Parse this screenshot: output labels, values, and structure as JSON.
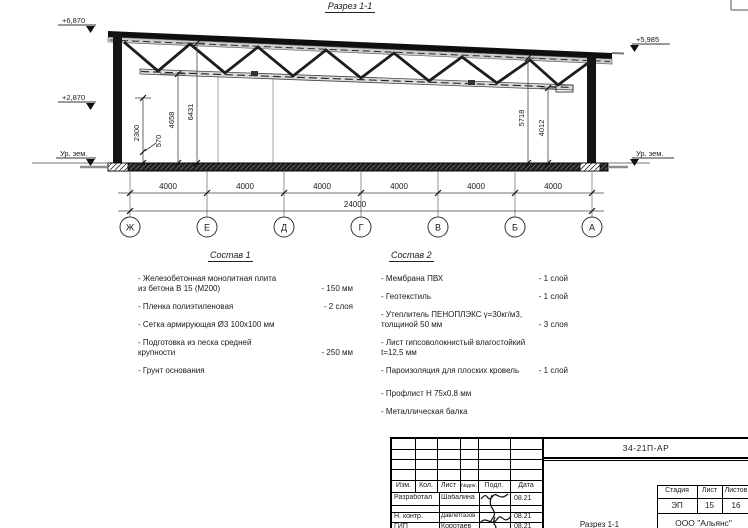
{
  "sheet": {
    "title": "Разрез 1-1"
  },
  "section": {
    "elev_left_top": "+6,870",
    "elev_left_mid": "+2,870",
    "elev_left_ground": "Ур. зем.",
    "elev_right_top": "+5,985",
    "elev_right_ground": "Ур. зем.",
    "dim_2300": "2300",
    "dim_570": "570",
    "dim_4658": "4658",
    "dim_6431": "6431",
    "dim_5718": "5718",
    "dim_4012": "4012",
    "bay_dim": "4000",
    "total_dim": "24000",
    "axes": [
      "Ж",
      "Е",
      "Д",
      "Г",
      "В",
      "Б",
      "А"
    ]
  },
  "composition1": {
    "title": "Состав 1",
    "items": [
      {
        "text": "- Железобетонная  монолитная плита\n  из бетона В 15 (М200)",
        "qty": "- 150 мм"
      },
      {
        "text": "- Пленка полиэтиленовая",
        "qty": "- 2 слоя"
      },
      {
        "text": "- Сетка армирующая Ø3 100х100 мм",
        "qty": ""
      },
      {
        "text": "- Подготовка из песка средней\n  крупности",
        "qty": "- 250 мм"
      },
      {
        "text": "- Грунт основания",
        "qty": ""
      }
    ]
  },
  "composition2": {
    "title": "Состав 2",
    "items": [
      {
        "text": "- Мембрана ПВХ",
        "qty": "- 1 слой"
      },
      {
        "text": "- Геотекстиль",
        "qty": "- 1 слой"
      },
      {
        "text": "- Утеплитель ПЕНОПЛЭКС γ=30кг/м3,\n  толщиной 50 мм",
        "qty": "- 3 слоя"
      },
      {
        "text": "- Лист гипсоволокнистый влагостойкий\n  t=12,5 мм",
        "qty": ""
      },
      {
        "text": "- Пароизоляция для плоских кровель",
        "qty": "- 1 слой"
      },
      {
        "text": "- Профлист Н 75х0.8 мм",
        "qty": ""
      },
      {
        "text": "- Металлическая балка",
        "qty": ""
      }
    ]
  },
  "titleblock": {
    "doc_code": "34-21П-АР",
    "columns": [
      "Изм.",
      "Кол.",
      "Лист",
      "№док.",
      "Подл.",
      "Дата"
    ],
    "rows": [
      {
        "role": "Разработал",
        "name": "Шабалина",
        "date": "08.21"
      },
      {
        "role": "Н. контр.",
        "name": "Давлетгазов",
        "date": "08.21"
      },
      {
        "role": "ГИП",
        "name": "Коротаев",
        "date": "08.21"
      }
    ],
    "drawing_name": "Разрез 1-1",
    "stage_label": "Стадия",
    "sheet_label": "Лист",
    "sheets_label": "Листов",
    "stage": "ЭП",
    "sheet": "15",
    "sheets": "16",
    "company": "ООО \"Альянс\""
  }
}
